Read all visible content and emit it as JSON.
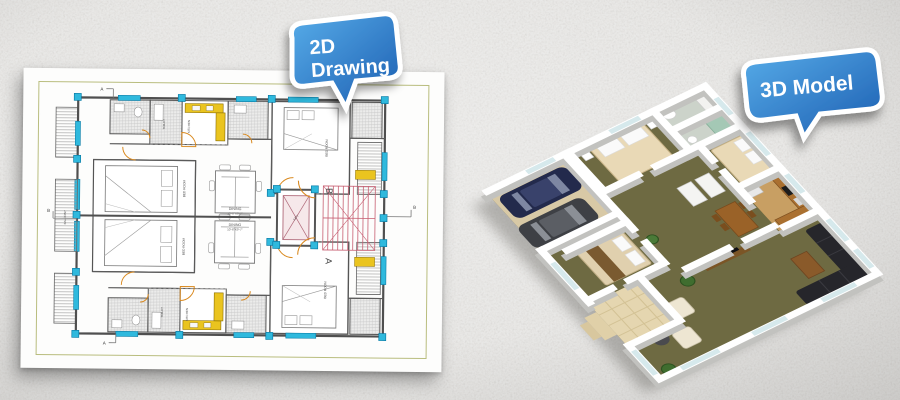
{
  "scene": {
    "background_color": "#d2d1cf",
    "texture": "stucco-noise"
  },
  "callouts": {
    "two_d": {
      "line1": "2D",
      "line2": "Drawing",
      "fill_top": "#58ade9",
      "fill_bottom": "#1a5cb0",
      "border_color": "#ffffff",
      "text_color": "#ffffff"
    },
    "three_d": {
      "label": "3D Model",
      "fill_top": "#58ade9",
      "fill_bottom": "#1a5cb0",
      "border_color": "#ffffff",
      "text_color": "#ffffff"
    }
  },
  "floorplan": {
    "frame_color": "#b9bd7e",
    "wall_color": "#4f4f4f",
    "window_color": "#2fb9dd",
    "door_color": "#d9891f",
    "kitchen_color": "#eac41f",
    "stair_color": "#c75f72",
    "lift_fill": "#f6e8ea",
    "labels": {
      "lift": "LIFT",
      "dining": "DINING",
      "dining_dim": "10'-6\"X9'-7\"",
      "bedroom": "BED ROOM",
      "kitchen": "KITCHEN",
      "toilet": "TOILET",
      "balcony": "BALCONY",
      "unit_a": "A",
      "unit_b": "B",
      "section_a": "A",
      "section_b": "B"
    }
  },
  "model3d": {
    "wall_color": "#ffffff",
    "carpet_color": "#6e6a42",
    "garage_floor_color": "#d8c9a6",
    "patio_color": "#e5d6b0",
    "car1_color": "#232a4c",
    "car2_color": "#3e4045",
    "sofa_color": "#26262b",
    "bed_color": "#e9d9b6",
    "counter_color": "#aa7030"
  }
}
